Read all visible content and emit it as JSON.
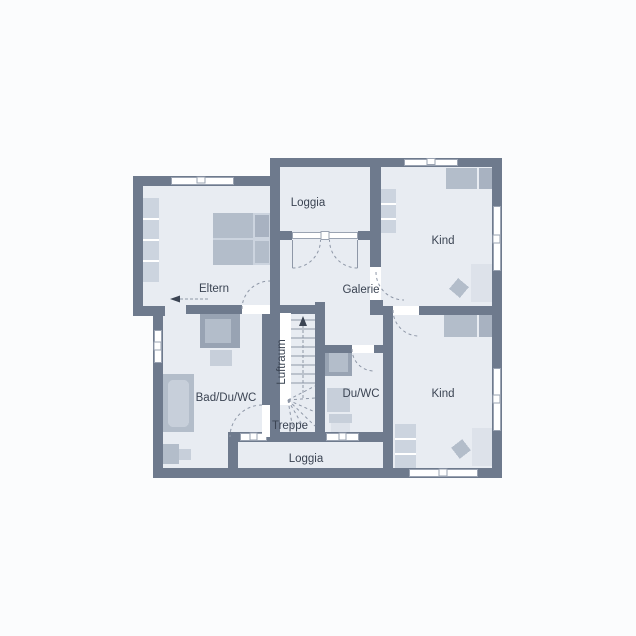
{
  "colors": {
    "bg": "#fbfcfd",
    "wall": "#6e7a8d",
    "floor": "#e8ecf2",
    "furniture": "#ccd4df",
    "furniture_mid": "#b3bdca",
    "furniture_dark": "#a8b2c1",
    "shower": "#98a3b3",
    "fixture": "#c7cfda",
    "fixture_light": "#dde2ea",
    "line": "#8e97a7",
    "window_frame": "#9aa3b2",
    "text": "#3b4453"
  },
  "rooms": {
    "eltern": {
      "label": "Eltern"
    },
    "loggia_top": {
      "label": "Loggia"
    },
    "kind_top": {
      "label": "Kind"
    },
    "galerie": {
      "label": "Galerie"
    },
    "luftraum": {
      "label": "Luftraum"
    },
    "treppe": {
      "label": "Treppe"
    },
    "bad": {
      "label": "Bad/Du/WC"
    },
    "duwc": {
      "label": "Du/WC"
    },
    "kind_bottom": {
      "label": "Kind"
    },
    "loggia_bottom": {
      "label": "Loggia"
    }
  }
}
